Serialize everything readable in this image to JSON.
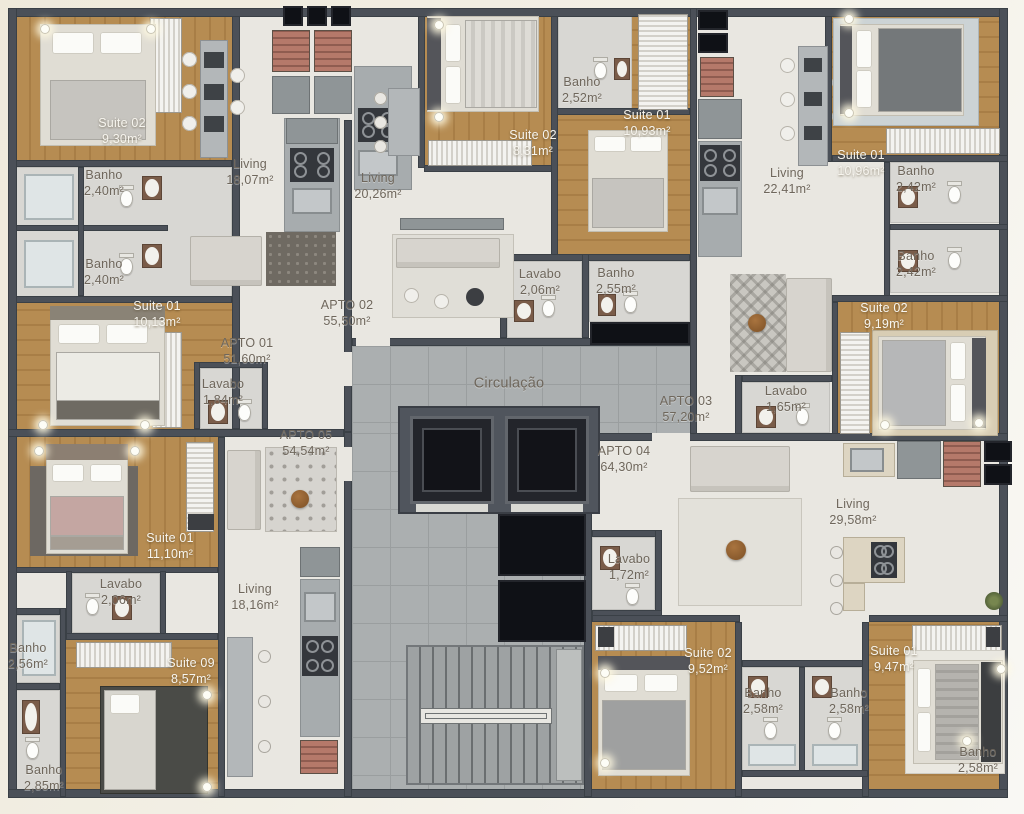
{
  "colors": {
    "wall": "#4b5058",
    "wood": "#b68c52",
    "tile": "#e9e7e1",
    "bath": "#d8d7d3",
    "circulation": "#abafb0",
    "shaft": "#0f1116",
    "brick": "#a86e60",
    "label_dark": "#6f675c",
    "label_light": "#f7f5ef"
  },
  "rooms": [
    {
      "name": "Suite 02",
      "area": "9,30m²",
      "x": 122,
      "y": 131,
      "style": "light"
    },
    {
      "name": "Banho",
      "area": "2,40m²",
      "x": 104,
      "y": 183,
      "style": "dark"
    },
    {
      "name": "Banho",
      "area": "2,40m²",
      "x": 104,
      "y": 272,
      "style": "dark"
    },
    {
      "name": "Suite 01",
      "area": "10,13m²",
      "x": 157,
      "y": 314,
      "style": "light"
    },
    {
      "name": "Living",
      "area": "18,07m²",
      "x": 250,
      "y": 172,
      "style": "dark"
    },
    {
      "name": "Living",
      "area": "20,26m²",
      "x": 378,
      "y": 186,
      "style": "dark"
    },
    {
      "name": "Suite 02",
      "area": "8,31m²",
      "x": 533,
      "y": 143,
      "style": "light"
    },
    {
      "name": "Banho",
      "area": "2,52m²",
      "x": 582,
      "y": 90,
      "style": "dark"
    },
    {
      "name": "Suite 01",
      "area": "10,93m²",
      "x": 647,
      "y": 123,
      "style": "light"
    },
    {
      "name": "Living",
      "area": "22,41m²",
      "x": 787,
      "y": 181,
      "style": "dark"
    },
    {
      "name": "Suite 01",
      "area": "10,96m²",
      "x": 861,
      "y": 163,
      "style": "light"
    },
    {
      "name": "Banho",
      "area": "2,42m²",
      "x": 916,
      "y": 179,
      "style": "dark"
    },
    {
      "name": "Banho",
      "area": "2,42m²",
      "x": 916,
      "y": 264,
      "style": "dark"
    },
    {
      "name": "Suite 02",
      "area": "9,19m²",
      "x": 884,
      "y": 316,
      "style": "light"
    },
    {
      "name": "Lavabo",
      "area": "2,06m²",
      "x": 540,
      "y": 282,
      "style": "dark"
    },
    {
      "name": "Banho",
      "area": "2,55m²",
      "x": 616,
      "y": 281,
      "style": "dark"
    },
    {
      "name": "APTO 02",
      "area": "55,50m²",
      "x": 347,
      "y": 313,
      "style": "dark"
    },
    {
      "name": "APTO 01",
      "area": "51,60m²",
      "x": 247,
      "y": 351,
      "style": "dark"
    },
    {
      "name": "Lavabo",
      "area": "1,84m²",
      "x": 223,
      "y": 392,
      "style": "dark"
    },
    {
      "name": "Circulação",
      "area": "",
      "x": 509,
      "y": 384,
      "style": "dark"
    },
    {
      "name": "APTO 03",
      "area": "57,20m²",
      "x": 686,
      "y": 409,
      "style": "dark"
    },
    {
      "name": "APTO 05",
      "area": "54,54m²",
      "x": 306,
      "y": 443,
      "style": "dark"
    },
    {
      "name": "APTO 04",
      "area": "64,30m²",
      "x": 624,
      "y": 459,
      "style": "dark"
    },
    {
      "name": "Lavabo",
      "area": "1,65m²",
      "x": 786,
      "y": 399,
      "style": "dark"
    },
    {
      "name": "Living",
      "area": "29,58m²",
      "x": 853,
      "y": 512,
      "style": "dark"
    },
    {
      "name": "Suite 01",
      "area": "11,10m²",
      "x": 170,
      "y": 546,
      "style": "light"
    },
    {
      "name": "Lavabo",
      "area": "2,06m²",
      "x": 121,
      "y": 592,
      "style": "dark"
    },
    {
      "name": "Living",
      "area": "18,16m²",
      "x": 255,
      "y": 597,
      "style": "dark"
    },
    {
      "name": "Banho",
      "area": "2,56m²",
      "x": 28,
      "y": 656,
      "style": "dark"
    },
    {
      "name": "Suite 09",
      "area": "8,57m²",
      "x": 191,
      "y": 671,
      "style": "light"
    },
    {
      "name": "Banho",
      "area": "2,85m²",
      "x": 44,
      "y": 778,
      "style": "dark"
    },
    {
      "name": "Lavabo",
      "area": "1,72m²",
      "x": 629,
      "y": 567,
      "style": "dark"
    },
    {
      "name": "Suite 02",
      "area": "9,52m²",
      "x": 708,
      "y": 661,
      "style": "light"
    },
    {
      "name": "Banho",
      "area": "2,58m²",
      "x": 763,
      "y": 701,
      "style": "dark"
    },
    {
      "name": "Banho",
      "area": "2,58m²",
      "x": 849,
      "y": 701,
      "style": "dark"
    },
    {
      "name": "Suite 01",
      "area": "9,47m²",
      "x": 894,
      "y": 659,
      "style": "light"
    },
    {
      "name": "Banho",
      "area": "2,58m²",
      "x": 978,
      "y": 760,
      "style": "dark"
    }
  ]
}
